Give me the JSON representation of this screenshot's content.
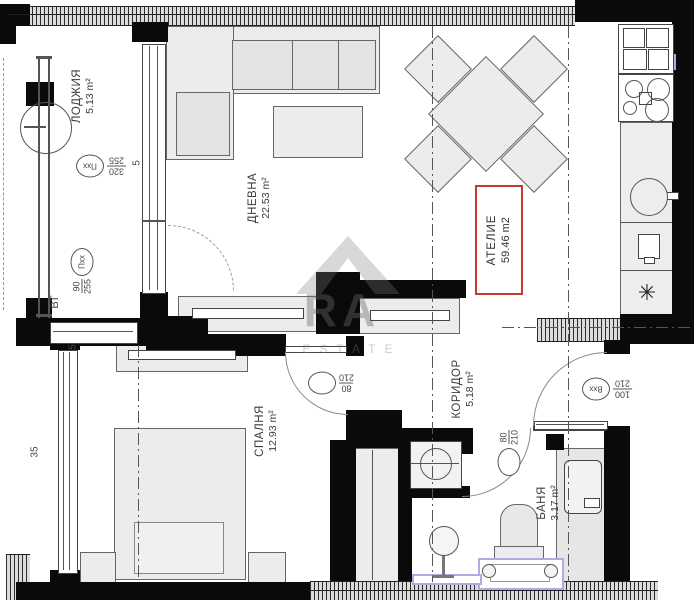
{
  "watermark": {
    "letters": "RA",
    "word": "ESTATE"
  },
  "rooms": {
    "loggia": {
      "name": "ЛОДЖИЯ",
      "area": "5.13 m²"
    },
    "living": {
      "name": "ДНЕВНА",
      "area": "22.53 m²"
    },
    "atelier": {
      "name": "АТЕЛИЕ",
      "area": "59.46 m2"
    },
    "corridor": {
      "name": "КОРИДОР",
      "area": "5.18 m²"
    },
    "bedroom": {
      "name": "СПАЛНЯ",
      "area": "12.93 m²"
    },
    "bath": {
      "name": "БАНЯ",
      "area": "3.17 m²"
    }
  },
  "markers": {
    "loggia_window": {
      "tag": "Пхх",
      "top": "255",
      "bottom": "320"
    },
    "vt_window": {
      "tag": "Пхх",
      "top": "90",
      "bottom": "255",
      "note": "ВТ"
    },
    "bedroom_door": {
      "tag": "",
      "top": "210",
      "bottom": "80"
    },
    "entrance_door": {
      "tag": "Вхх",
      "top": "210",
      "bottom": "100"
    },
    "bath_door": {
      "tag": "",
      "top": "80",
      "bottom": "210"
    }
  },
  "dimensions": {
    "window_living": "5",
    "wall_bedroom": "5",
    "wall_left": "35"
  },
  "icons": {
    "fridge": "✳"
  },
  "colors": {
    "wall": "#0a0a0a",
    "label_box_red": "#c23a30",
    "plumbing_lavender": "#b3a8e0"
  }
}
